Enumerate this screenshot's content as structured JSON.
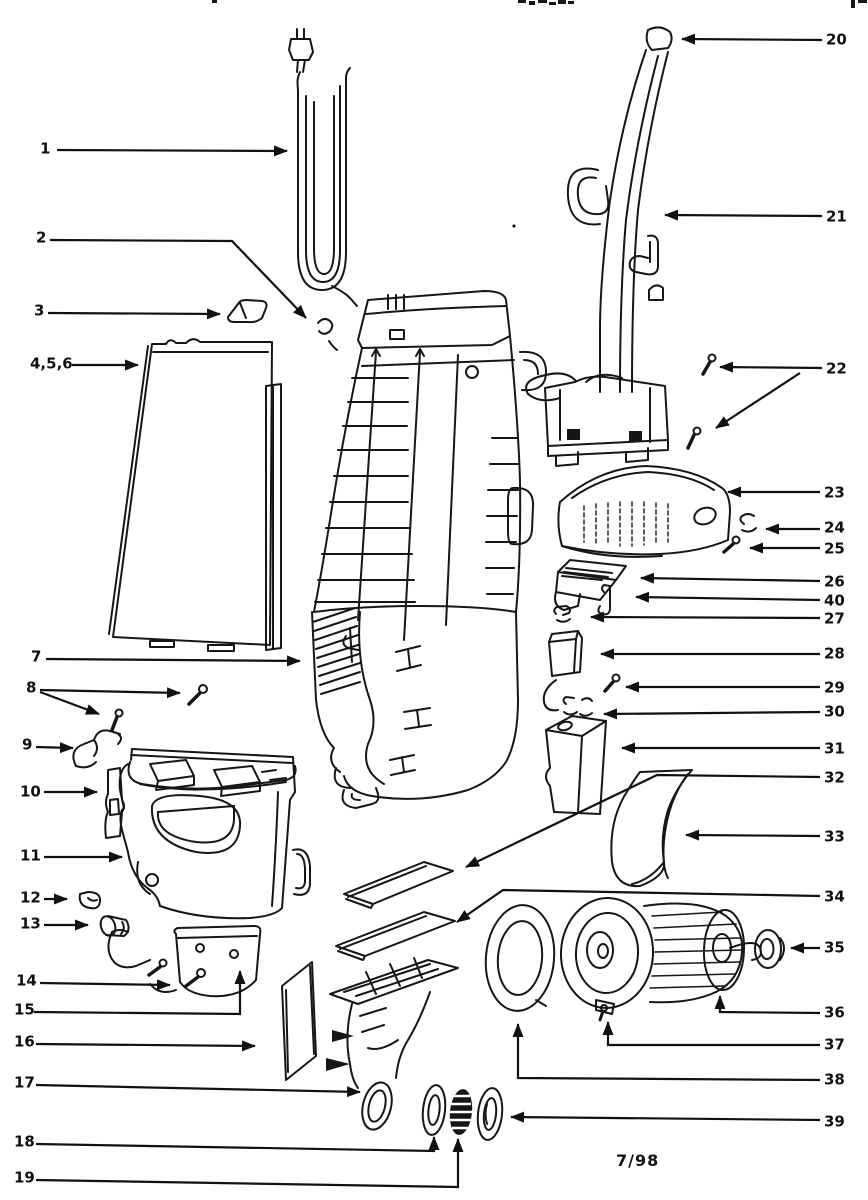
{
  "footer": {
    "date_code": "7/98"
  },
  "diagram": {
    "description_labels": [],
    "callouts": [
      {
        "label": "1",
        "x": 40,
        "y": 149,
        "leaders": [
          [
            [
              57,
              150
            ],
            [
              287,
              151
            ]
          ]
        ]
      },
      {
        "label": "2",
        "x": 36,
        "y": 238,
        "leaders": [
          [
            [
              50,
              240
            ],
            [
              232,
              241
            ],
            [
              306,
              318
            ]
          ]
        ]
      },
      {
        "label": "3",
        "x": 34,
        "y": 311,
        "leaders": [
          [
            [
              48,
              313
            ],
            [
              220,
              314
            ]
          ]
        ]
      },
      {
        "label": "4,5,6",
        "x": 30,
        "y": 364,
        "leaders": [
          [
            [
              72,
              365
            ],
            [
              138,
              365
            ]
          ]
        ]
      },
      {
        "label": "7",
        "x": 31,
        "y": 657,
        "leaders": [
          [
            [
              46,
              659
            ],
            [
              300,
              661
            ]
          ]
        ]
      },
      {
        "label": "8",
        "x": 26,
        "y": 688,
        "leaders": [
          [
            [
              40,
              690
            ],
            [
              180,
              693
            ]
          ],
          [
            [
              40,
              692
            ],
            [
              99,
              714
            ]
          ]
        ]
      },
      {
        "label": "9",
        "x": 22,
        "y": 745,
        "leaders": [
          [
            [
              36,
              747
            ],
            [
              73,
              748
            ]
          ]
        ]
      },
      {
        "label": "10",
        "x": 20,
        "y": 792,
        "leaders": [
          [
            [
              44,
              792
            ],
            [
              97,
              792
            ]
          ]
        ]
      },
      {
        "label": "11",
        "x": 20,
        "y": 856,
        "leaders": [
          [
            [
              44,
              857
            ],
            [
              122,
              857
            ]
          ]
        ]
      },
      {
        "label": "12",
        "x": 20,
        "y": 898,
        "leaders": [
          [
            [
              44,
              899
            ],
            [
              67,
              899
            ]
          ]
        ]
      },
      {
        "label": "13",
        "x": 20,
        "y": 924,
        "leaders": [
          [
            [
              44,
              925
            ],
            [
              88,
              925
            ]
          ]
        ]
      },
      {
        "label": "14",
        "x": 16,
        "y": 981,
        "leaders": [
          [
            [
              40,
              983
            ],
            [
              170,
              985
            ]
          ]
        ]
      },
      {
        "label": "15",
        "x": 14,
        "y": 1010,
        "leaders": [
          [
            [
              34,
              1012
            ],
            [
              240,
              1014
            ],
            [
              240,
              971
            ]
          ]
        ]
      },
      {
        "label": "16",
        "x": 14,
        "y": 1042,
        "leaders": [
          [
            [
              36,
              1044
            ],
            [
              255,
              1046
            ]
          ]
        ]
      },
      {
        "label": "17",
        "x": 14,
        "y": 1083,
        "leaders": [
          [
            [
              36,
              1085
            ],
            [
              360,
              1092
            ]
          ]
        ]
      },
      {
        "label": "18",
        "x": 14,
        "y": 1142,
        "leaders": [
          [
            [
              36,
              1144
            ],
            [
              434,
              1151
            ],
            [
              434,
              1137
            ]
          ]
        ]
      },
      {
        "label": "19",
        "x": 14,
        "y": 1178,
        "leaders": [
          [
            [
              36,
              1180
            ],
            [
              458,
              1187
            ],
            [
              458,
              1139
            ]
          ]
        ]
      },
      {
        "label": "20",
        "x": 826,
        "y": 40,
        "leaders": [
          [
            [
              822,
              40
            ],
            [
              682,
              39
            ]
          ]
        ]
      },
      {
        "label": "21",
        "x": 826,
        "y": 217,
        "leaders": [
          [
            [
              822,
              216
            ],
            [
              665,
              215
            ]
          ]
        ]
      },
      {
        "label": "22",
        "x": 826,
        "y": 369,
        "leaders": [
          [
            [
              822,
              368
            ],
            [
              720,
              367
            ]
          ],
          [
            [
              800,
              373
            ],
            [
              716,
              428
            ]
          ]
        ]
      },
      {
        "label": "23",
        "x": 824,
        "y": 493,
        "leaders": [
          [
            [
              820,
              492
            ],
            [
              728,
              492
            ]
          ]
        ]
      },
      {
        "label": "24",
        "x": 824,
        "y": 528,
        "leaders": [
          [
            [
              820,
              529
            ],
            [
              766,
              529
            ]
          ]
        ]
      },
      {
        "label": "25",
        "x": 824,
        "y": 549,
        "leaders": [
          [
            [
              820,
              548
            ],
            [
              750,
              548
            ]
          ]
        ]
      },
      {
        "label": "26",
        "x": 824,
        "y": 582,
        "leaders": [
          [
            [
              820,
              581
            ],
            [
              641,
              578
            ]
          ]
        ]
      },
      {
        "label": "40",
        "x": 824,
        "y": 601,
        "leaders": [
          [
            [
              820,
              600
            ],
            [
              636,
              597
            ]
          ]
        ]
      },
      {
        "label": "27",
        "x": 824,
        "y": 619,
        "leaders": [
          [
            [
              820,
              618
            ],
            [
              591,
              617
            ]
          ]
        ]
      },
      {
        "label": "28",
        "x": 824,
        "y": 654,
        "leaders": [
          [
            [
              820,
              654
            ],
            [
              601,
              654
            ]
          ]
        ]
      },
      {
        "label": "29",
        "x": 824,
        "y": 688,
        "leaders": [
          [
            [
              820,
              687
            ],
            [
              626,
              687
            ]
          ]
        ]
      },
      {
        "label": "30",
        "x": 824,
        "y": 712,
        "leaders": [
          [
            [
              820,
              712
            ],
            [
              604,
              714
            ]
          ]
        ]
      },
      {
        "label": "31",
        "x": 824,
        "y": 749,
        "leaders": [
          [
            [
              820,
              748
            ],
            [
              622,
              748
            ]
          ]
        ]
      },
      {
        "label": "32",
        "x": 824,
        "y": 778,
        "leaders": [
          [
            [
              820,
              777
            ],
            [
              657,
              775
            ],
            [
              466,
              867
            ]
          ]
        ]
      },
      {
        "label": "33",
        "x": 824,
        "y": 837,
        "leaders": [
          [
            [
              820,
              836
            ],
            [
              686,
              835
            ]
          ]
        ]
      },
      {
        "label": "34",
        "x": 824,
        "y": 897,
        "leaders": [
          [
            [
              820,
              896
            ],
            [
              503,
              890
            ],
            [
              457,
              922
            ]
          ]
        ]
      },
      {
        "label": "35",
        "x": 824,
        "y": 948,
        "leaders": [
          [
            [
              820,
              948
            ],
            [
              791,
              948
            ]
          ]
        ]
      },
      {
        "label": "36",
        "x": 824,
        "y": 1013,
        "leaders": [
          [
            [
              820,
              1013
            ],
            [
              720,
              1012
            ],
            [
              720,
              996
            ]
          ]
        ]
      },
      {
        "label": "37",
        "x": 824,
        "y": 1045,
        "leaders": [
          [
            [
              820,
              1045
            ],
            [
              608,
              1045
            ],
            [
              608,
              1022
            ]
          ]
        ]
      },
      {
        "label": "38",
        "x": 824,
        "y": 1080,
        "leaders": [
          [
            [
              820,
              1080
            ],
            [
              518,
              1078
            ],
            [
              518,
              1024
            ]
          ]
        ]
      },
      {
        "label": "39",
        "x": 824,
        "y": 1122,
        "leaders": [
          [
            [
              820,
              1120
            ],
            [
              511,
              1117
            ]
          ]
        ]
      }
    ]
  }
}
